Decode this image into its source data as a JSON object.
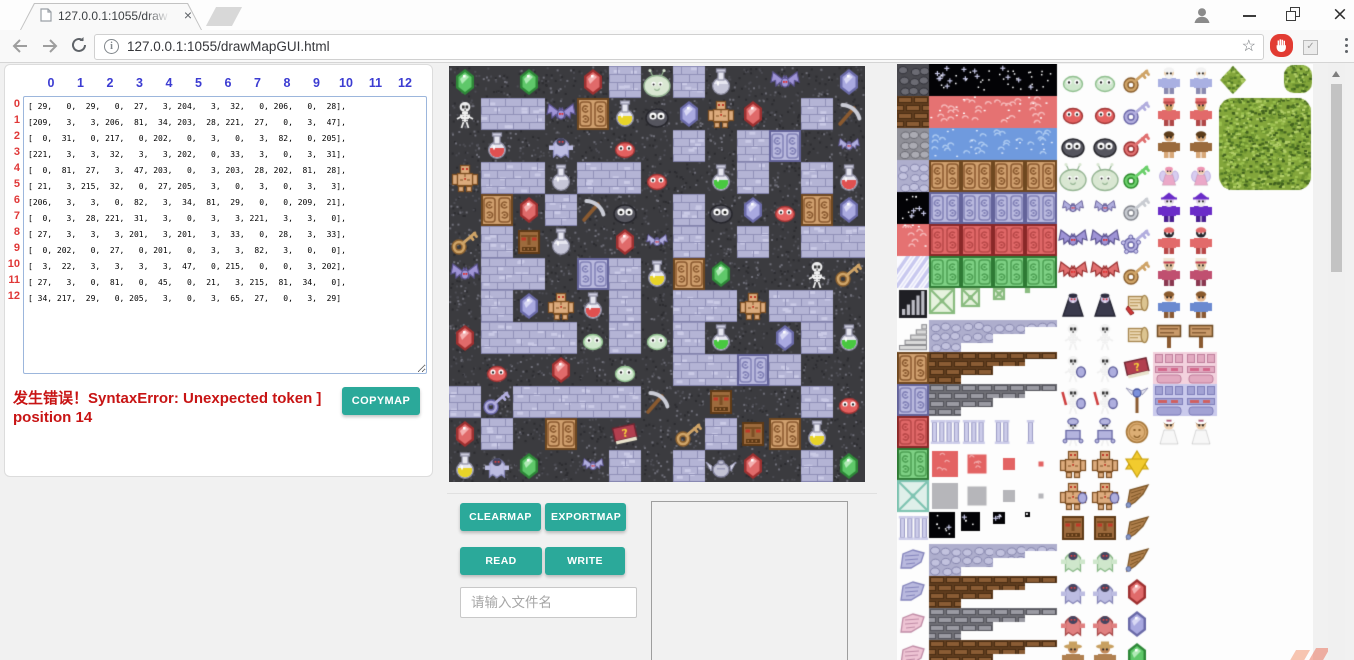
{
  "browser": {
    "tab_title": "127.0.0.1:1055/drawMa",
    "tab_close_glyph": "×",
    "url": "127.0.0.1:1055/drawMapGUI.html",
    "star_glyph": "☆",
    "check_glyph": "✓",
    "window_close_glyph": "×"
  },
  "matrix_panel": {
    "col_headers": [
      "0",
      "1",
      "2",
      "3",
      "4",
      "5",
      "6",
      "7",
      "8",
      "9",
      "10",
      "11",
      "12"
    ],
    "row_labels": [
      "0",
      "1",
      "2",
      "3",
      "4",
      "5",
      "6",
      "7",
      "8",
      "9",
      "10",
      "11",
      "12"
    ],
    "error_line1": "发生错误！SyntaxError: Unexpected token ]",
    "error_line2": "position 14",
    "copymap_label": "COPYMAP"
  },
  "map_matrix": [
    [
      29,
      0,
      29,
      0,
      27,
      3,
      204,
      3,
      32,
      0,
      206,
      0,
      28
    ],
    [
      209,
      3,
      3,
      206,
      81,
      34,
      203,
      28,
      221,
      27,
      0,
      3,
      47
    ],
    [
      0,
      31,
      0,
      217,
      0,
      202,
      0,
      3,
      0,
      3,
      82,
      0,
      205
    ],
    [
      221,
      3,
      3,
      32,
      3,
      3,
      202,
      0,
      33,
      3,
      0,
      3,
      31
    ],
    [
      0,
      81,
      27,
      3,
      47,
      203,
      0,
      3,
      203,
      28,
      202,
      81,
      28
    ],
    [
      21,
      3,
      215,
      32,
      0,
      27,
      205,
      3,
      0,
      3,
      0,
      3,
      3
    ],
    [
      206,
      3,
      3,
      0,
      82,
      3,
      34,
      81,
      29,
      0,
      0,
      209,
      21
    ],
    [
      0,
      3,
      28,
      221,
      31,
      3,
      0,
      3,
      3,
      221,
      3,
      3,
      0
    ],
    [
      27,
      3,
      3,
      3,
      201,
      3,
      201,
      3,
      33,
      0,
      28,
      3,
      33
    ],
    [
      0,
      202,
      0,
      27,
      0,
      201,
      0,
      3,
      3,
      82,
      3,
      0,
      0
    ],
    [
      3,
      22,
      3,
      3,
      3,
      3,
      47,
      0,
      215,
      0,
      0,
      3,
      202
    ],
    [
      27,
      3,
      0,
      81,
      0,
      45,
      0,
      21,
      3,
      215,
      81,
      34,
      0
    ],
    [
      34,
      217,
      29,
      0,
      205,
      3,
      0,
      3,
      65,
      27,
      0,
      3,
      29
    ]
  ],
  "tile_legend": {
    "0": "dark-wall",
    "3": "brick-floor",
    "21": "key-bronze",
    "22": "key-silver",
    "27": "gem-red",
    "28": "gem-purple",
    "29": "gem-green",
    "31": "potion-red",
    "32": "potion-silver",
    "33": "potion-green",
    "34": "potion-yellow",
    "45": "book",
    "47": "pickaxe",
    "65": "winged-jar",
    "81": "door-brown",
    "82": "door-lavender",
    "201": "slime-pale",
    "202": "slime-red",
    "203": "slime-dark",
    "204": "slime-big",
    "205": "bat-small",
    "206": "bat-large",
    "209": "skeleton",
    "215": "stone-face",
    "217": "ghost",
    "221": "golem"
  },
  "controls": {
    "clearmap_label": "CLEARMAP",
    "exportmap_label": "EXPORTMAP",
    "read_label": "READ",
    "write_label": "WRITE",
    "filename_placeholder": "请输入文件名"
  },
  "colors": {
    "accent_teal": "#2ba99a",
    "error_red": "#c81414",
    "header_blue": "#3c3cd2",
    "row_label_red": "#e03838"
  },
  "tileset": {
    "col0": [
      "stoneD",
      "brickB",
      "stoneG",
      "cobbleL",
      "star",
      "waterR",
      "diag",
      "bars",
      "stairs",
      "doorT",
      "door82",
      "doorR",
      "doorG",
      "latT",
      "pillarT",
      "wingL",
      "wingL",
      "wingP",
      "wingP"
    ],
    "rows": [
      [
        "star",
        0,
        "full"
      ],
      [
        "waterR",
        1,
        "full"
      ],
      [
        "waterB",
        2,
        "full"
      ],
      [
        "doorT",
        3,
        "full"
      ],
      [
        "door82",
        4,
        "full"
      ],
      [
        "doorR",
        5,
        "full"
      ],
      [
        "doorG",
        6,
        "full"
      ],
      [
        "latM",
        7,
        "shrink"
      ],
      [
        "cobbleL",
        8,
        "step"
      ],
      [
        "brickB",
        9,
        "step"
      ],
      [
        "brickG",
        10,
        "step"
      ],
      [
        "pillarT",
        11,
        "pill"
      ],
      [
        "redsq",
        12,
        "shrink"
      ],
      [
        "graysq",
        13,
        "shrink"
      ],
      [
        "starsq",
        14,
        "shrink"
      ],
      [
        "cobbleL",
        15,
        "step"
      ],
      [
        "brickB",
        16,
        "step"
      ],
      [
        "brickG",
        17,
        "step"
      ],
      [
        "brickB",
        18,
        "step"
      ]
    ],
    "sprite_pairs": [
      "slimeG",
      "slimeR",
      "slimeD",
      "bigSlime",
      "batS",
      "batL",
      "batR",
      "vamp",
      "skel",
      "skelSh",
      "skelSw",
      "skelAr",
      "golem",
      "golemSh",
      "face",
      "ghostG",
      "ghostL",
      "ghostR",
      "hatguy"
    ],
    "items": [
      "keyT",
      "keyL",
      "keyR",
      "keyG",
      "keyS",
      "keyO",
      "keyT",
      "scrollR",
      "scrollT",
      "book",
      "staff",
      "coin",
      "star6",
      "wingB",
      "wingB",
      "wingB",
      "gemR",
      "gemL",
      "gemG"
    ],
    "char_pairs": [
      "oldman",
      "dwarf",
      "caveman",
      "fairy",
      "wizard",
      "skullhood",
      "priest",
      "boy",
      "sign",
      "pinkwall",
      "lavwall",
      "bride"
    ]
  }
}
